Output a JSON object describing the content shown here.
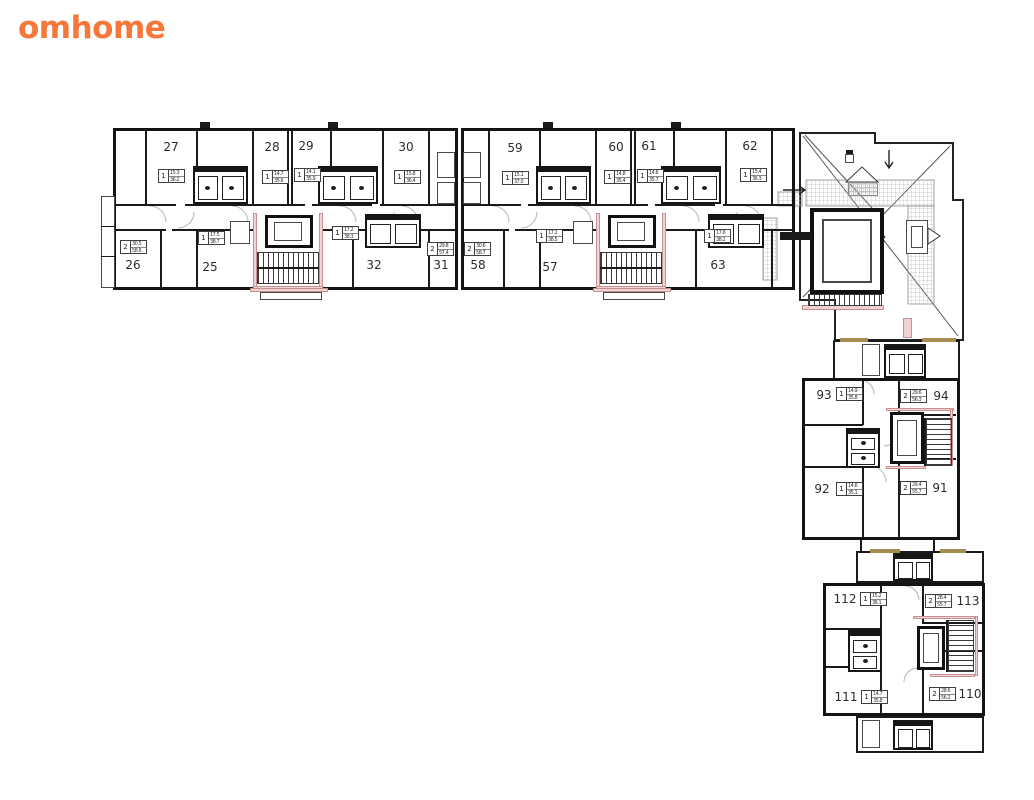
{
  "brand": {
    "logo": "omhome",
    "logo_color": "#F5783A"
  },
  "plan": {
    "colors": {
      "wall": "#1A1A1A",
      "highlight_pink": "#F2D3D3",
      "accent_tan": "#A68D52"
    },
    "apartments": [
      {
        "number": "27",
        "rooms": "1",
        "area_upper": "15.3",
        "area_lower": "36.2"
      },
      {
        "number": "28",
        "rooms": "1",
        "area_upper": "14.7",
        "area_lower": "35.6"
      },
      {
        "number": "29",
        "rooms": "1",
        "area_upper": "14.1",
        "area_lower": "35.9"
      },
      {
        "number": "30",
        "rooms": "1",
        "area_upper": "15.8",
        "area_lower": "36.4"
      },
      {
        "number": "26",
        "rooms": "2",
        "area_upper": "30.5",
        "area_lower": "58.6"
      },
      {
        "number": "25",
        "rooms": "1",
        "area_upper": "17.5",
        "area_lower": "38.7"
      },
      {
        "number": "32",
        "rooms": "1",
        "area_upper": "17.2",
        "area_lower": "38.3"
      },
      {
        "number": "31",
        "rooms": "2",
        "area_upper": "29.8",
        "area_lower": "57.4"
      },
      {
        "number": "59",
        "rooms": "1",
        "area_upper": "15.1",
        "area_lower": "37.0"
      },
      {
        "number": "60",
        "rooms": "1",
        "area_upper": "14.8",
        "area_lower": "35.4"
      },
      {
        "number": "61",
        "rooms": "1",
        "area_upper": "14.6",
        "area_lower": "35.7"
      },
      {
        "number": "62",
        "rooms": "1",
        "area_upper": "15.4",
        "area_lower": "36.3"
      },
      {
        "number": "58",
        "rooms": "2",
        "area_upper": "30.6",
        "area_lower": "58.7"
      },
      {
        "number": "57",
        "rooms": "1",
        "area_upper": "17.2",
        "area_lower": "38.5"
      },
      {
        "number": "63",
        "rooms": "1",
        "area_upper": "17.6",
        "area_lower": "38.2"
      },
      {
        "number": "93",
        "rooms": "1",
        "area_upper": "14.9",
        "area_lower": "35.8"
      },
      {
        "number": "94",
        "rooms": "2",
        "area_upper": "29.6",
        "area_lower": "56.3"
      },
      {
        "number": "92",
        "rooms": "1",
        "area_upper": "14.6",
        "area_lower": "35.1"
      },
      {
        "number": "91",
        "rooms": "2",
        "area_upper": "29.4",
        "area_lower": "55.7"
      },
      {
        "number": "112",
        "rooms": "1",
        "area_upper": "15.2",
        "area_lower": "36.1"
      },
      {
        "number": "113",
        "rooms": "2",
        "area_upper": "28.4",
        "area_lower": "55.7"
      },
      {
        "number": "111",
        "rooms": "1",
        "area_upper": "14.7",
        "area_lower": "35.8"
      },
      {
        "number": "110",
        "rooms": "2",
        "area_upper": "28.6",
        "area_lower": "56.2"
      }
    ]
  }
}
